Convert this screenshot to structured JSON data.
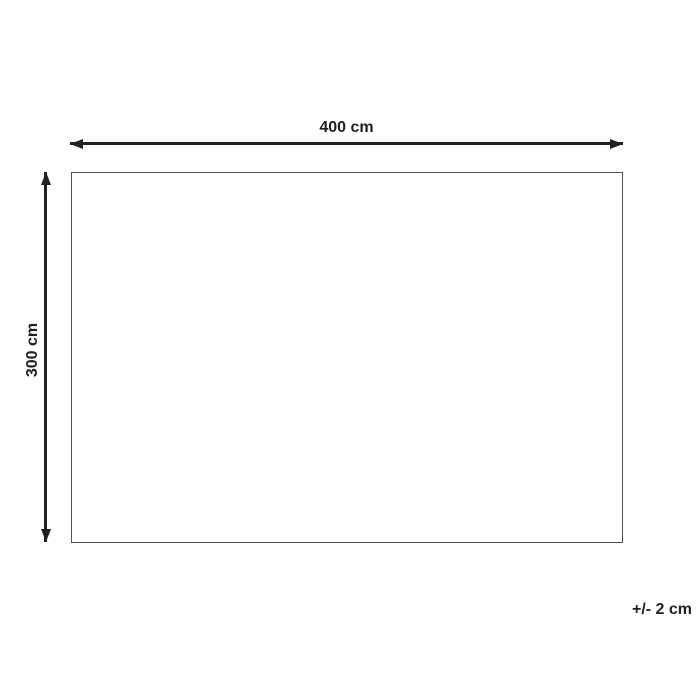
{
  "diagram": {
    "type": "product-dimension-diagram",
    "width_label": "400 cm",
    "height_label": "300 cm",
    "tolerance_label": "+/- 2 cm",
    "colors": {
      "background": "#ffffff",
      "arrow": "#231f20",
      "text": "#231f20",
      "rectangle_border": "#4e4f52"
    }
  }
}
